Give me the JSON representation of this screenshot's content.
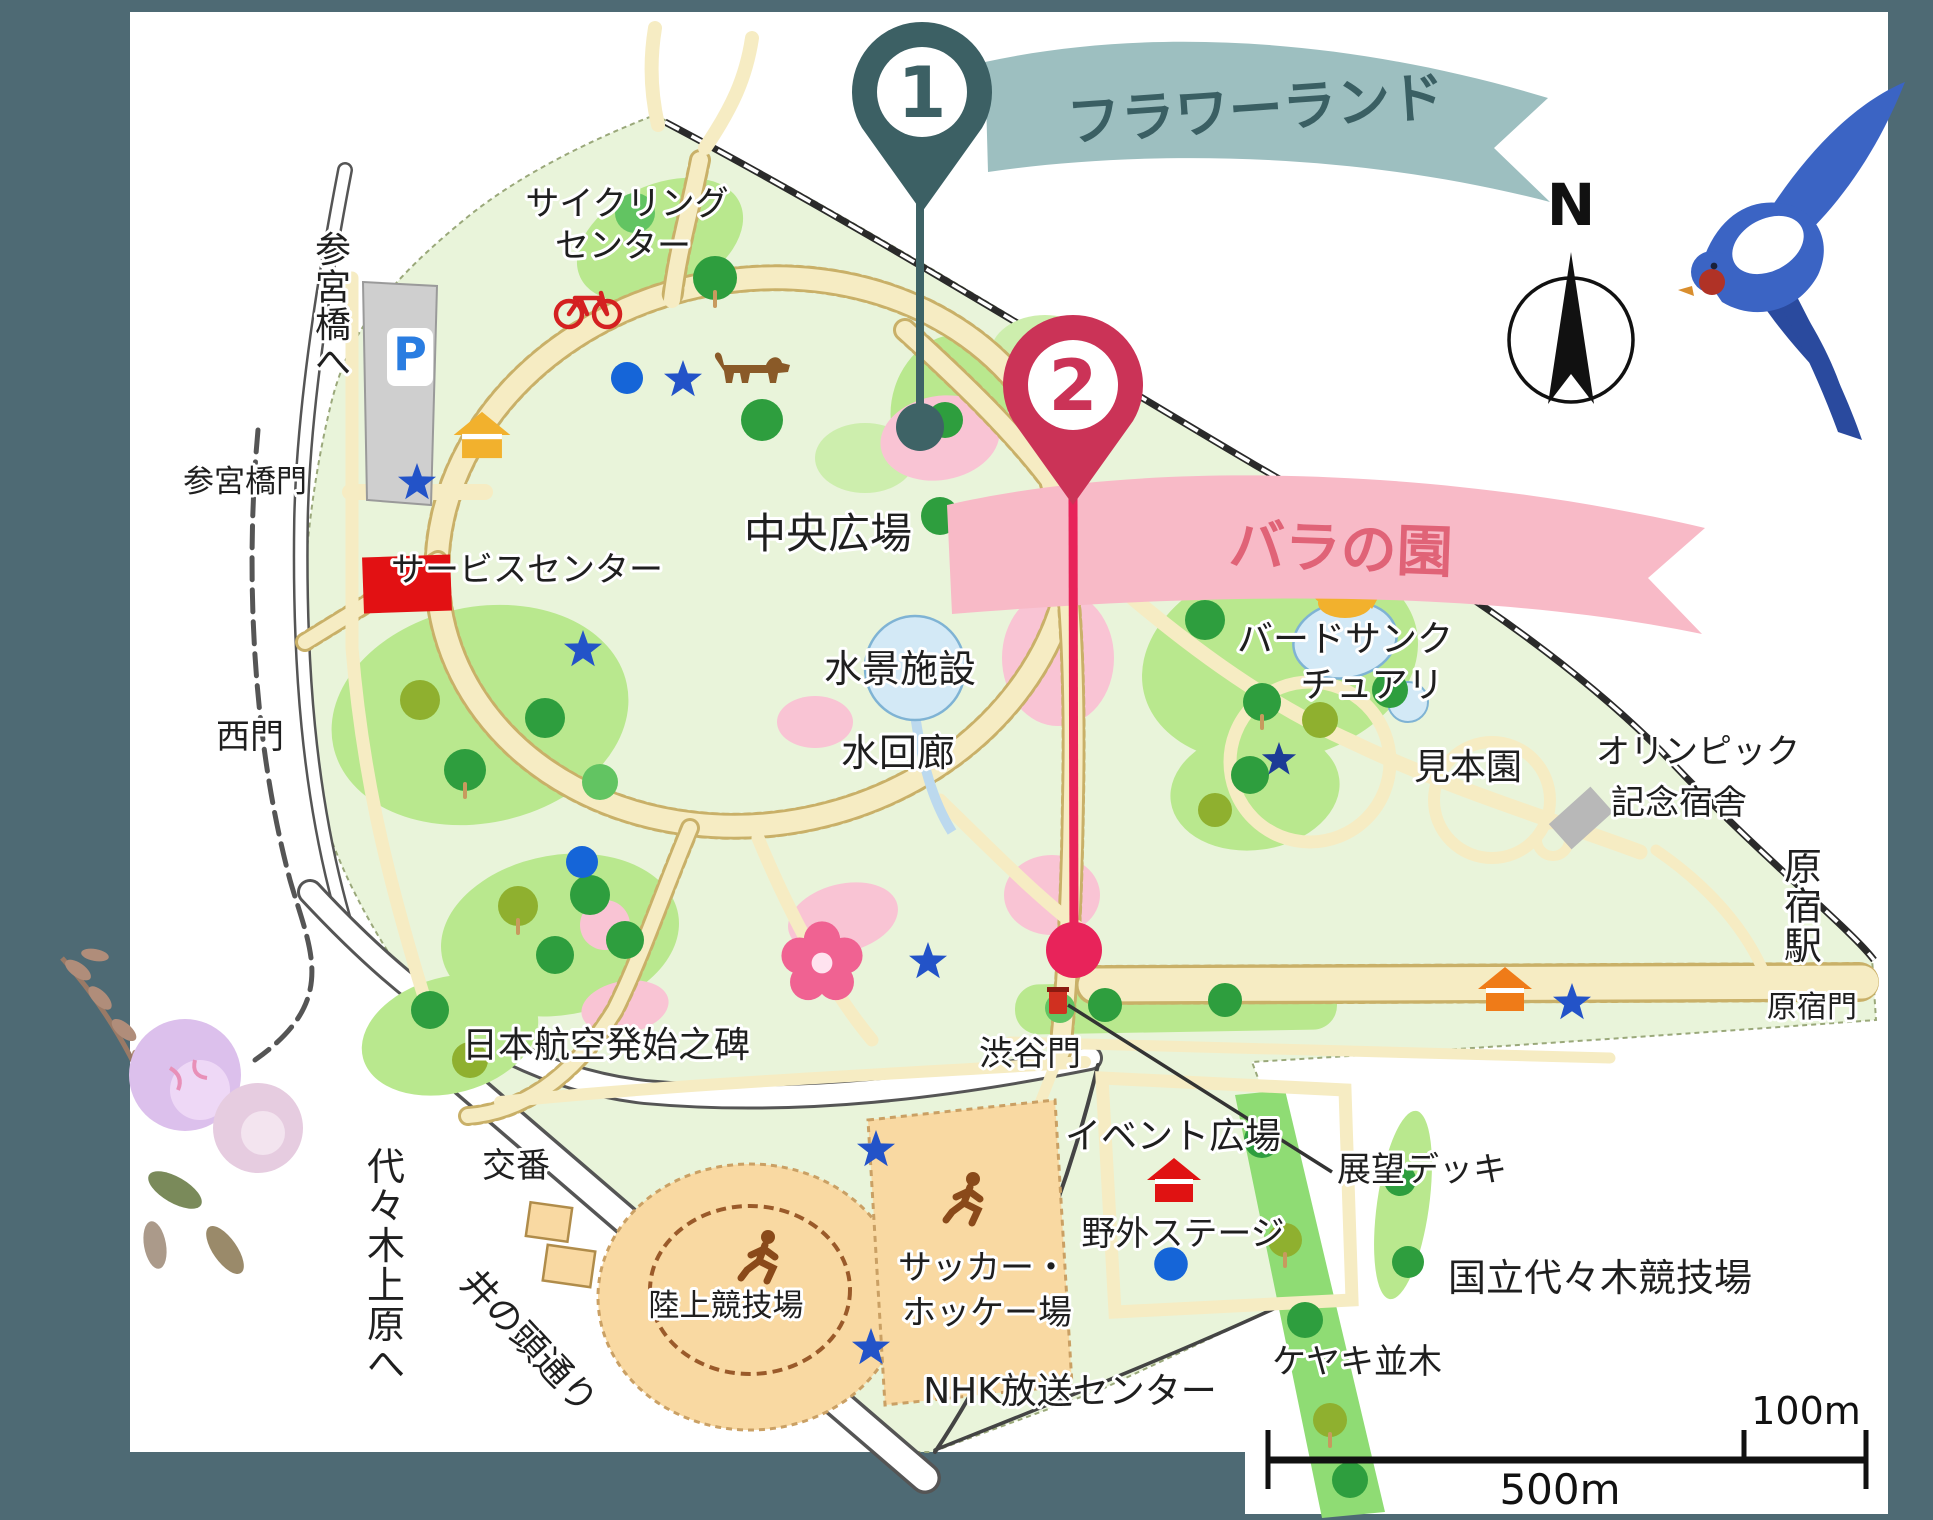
{
  "frame": {
    "background": "#4e6a74",
    "panel": "#ffffff"
  },
  "markers": [
    {
      "number": "1",
      "label": "フラワーランド",
      "pin_color": "#3c6064",
      "stem_color": "#3e6366",
      "banner_bg": "#9dbfc0",
      "banner_text_color": "#3a5f63",
      "pin": {
        "x": 922,
        "y": 92
      },
      "dot": {
        "x": 920,
        "y": 427
      }
    },
    {
      "number": "2",
      "label": "バラの園",
      "pin_color": "#cb3357",
      "stem_color": "#e8235a",
      "banner_bg": "#f8bac7",
      "banner_text_color": "#e06377",
      "pin": {
        "x": 1073,
        "y": 385
      },
      "dot": {
        "x": 1074,
        "y": 950
      }
    }
  ],
  "compass": {
    "label": "N"
  },
  "scale_bar": {
    "long_label": "500m",
    "short_label": "100m"
  },
  "map": {
    "label_color": "#1f1f1f",
    "labels": [
      {
        "id": "cycling-center-1",
        "text": "サイクリング",
        "x": 627,
        "y": 215,
        "size": 34
      },
      {
        "id": "cycling-center-2",
        "text": "センター",
        "x": 623,
        "y": 257,
        "size": 34
      },
      {
        "id": "sangubashi-e",
        "text": "参宮橋へ",
        "x": 333,
        "y": 262,
        "size": 36,
        "vertical": true
      },
      {
        "id": "sangubashi-gate",
        "text": "参宮橋門",
        "x": 245,
        "y": 492,
        "size": 31
      },
      {
        "id": "service-center",
        "text": "サービスセンター",
        "x": 527,
        "y": 581,
        "size": 34
      },
      {
        "id": "west-gate",
        "text": "西門",
        "x": 250,
        "y": 748,
        "size": 34
      },
      {
        "id": "central-square",
        "text": "中央広場",
        "x": 828,
        "y": 548,
        "size": 42
      },
      {
        "id": "water-feature",
        "text": "水景施設",
        "x": 900,
        "y": 682,
        "size": 38
      },
      {
        "id": "water-corridor",
        "text": "水回廊",
        "x": 898,
        "y": 766,
        "size": 38
      },
      {
        "id": "bird-sanctuary-1",
        "text": "バードサンク",
        "x": 1345,
        "y": 651,
        "size": 36
      },
      {
        "id": "bird-sanctuary-2",
        "text": "チュアリ",
        "x": 1372,
        "y": 697,
        "size": 36
      },
      {
        "id": "sample-garden",
        "text": "見本園",
        "x": 1468,
        "y": 779,
        "size": 36
      },
      {
        "id": "olympic-1",
        "text": "オリンピック",
        "x": 1698,
        "y": 763,
        "size": 34
      },
      {
        "id": "olympic-2",
        "text": "記念宿舎",
        "x": 1679,
        "y": 814,
        "size": 34
      },
      {
        "id": "harajuku-sta",
        "text": "原宿駅",
        "x": 1803,
        "y": 880,
        "size": 38,
        "vertical": true
      },
      {
        "id": "harajuku-gate",
        "text": "原宿門",
        "x": 1812,
        "y": 1017,
        "size": 30
      },
      {
        "id": "shibuya-gate",
        "text": "渋谷門",
        "x": 1030,
        "y": 1065,
        "size": 34
      },
      {
        "id": "observation-deck",
        "text": "展望デッキ",
        "x": 1422,
        "y": 1181,
        "size": 34
      },
      {
        "id": "event-plaza",
        "text": "イベント広場",
        "x": 1173,
        "y": 1148,
        "size": 36
      },
      {
        "id": "outdoor-stage",
        "text": "野外ステージ",
        "x": 1183,
        "y": 1245,
        "size": 34
      },
      {
        "id": "jal-monument",
        "text": "日本航空発始之碑",
        "x": 606,
        "y": 1057,
        "size": 36
      },
      {
        "id": "police-box",
        "text": "交番",
        "x": 516,
        "y": 1177,
        "size": 34
      },
      {
        "id": "athletics-field",
        "text": "陸上競技場",
        "x": 726,
        "y": 1316,
        "size": 31
      },
      {
        "id": "soccer-1",
        "text": "サッカー・",
        "x": 983,
        "y": 1279,
        "size": 34
      },
      {
        "id": "soccer-2",
        "text": "ホッケー場",
        "x": 987,
        "y": 1324,
        "size": 34
      },
      {
        "id": "yoyogi-uehara-e",
        "text": "代々木上原へ",
        "x": 386,
        "y": 1180,
        "size": 38,
        "vertical": true
      },
      {
        "id": "inokashira-st",
        "text": "井の頭通り",
        "x": 520,
        "y": 1350,
        "size": 36,
        "rotate": 47
      },
      {
        "id": "nhk-center",
        "text": "NHK放送センター",
        "x": 1070,
        "y": 1403,
        "size": 36
      },
      {
        "id": "zelkova-row",
        "text": "ケヤキ並木",
        "x": 1357,
        "y": 1373,
        "size": 34
      },
      {
        "id": "national-stadium",
        "text": "国立代々木競技場",
        "x": 1600,
        "y": 1291,
        "size": 38
      },
      {
        "id": "parking-p",
        "text": "P",
        "x": 410,
        "y": 370,
        "size": 46,
        "bold": true,
        "color": "#2a7de1"
      }
    ],
    "icons": [
      {
        "type": "star",
        "name": "star-icon-parking",
        "x": 417,
        "y": 483,
        "color": "#2353c8"
      },
      {
        "type": "star",
        "name": "star-icon-dogrun",
        "x": 683,
        "y": 380,
        "color": "#2353c8"
      },
      {
        "type": "star",
        "name": "star-icon-service",
        "x": 583,
        "y": 650,
        "color": "#2353c8"
      },
      {
        "type": "star",
        "name": "star-icon-central",
        "x": 1003,
        "y": 515,
        "color": "#2353c8"
      },
      {
        "type": "star",
        "name": "star-icon-sanctuary",
        "x": 1279,
        "y": 760,
        "color": "#1c3c96",
        "scale": 0.9
      },
      {
        "type": "star",
        "name": "star-icon-shibuya",
        "x": 928,
        "y": 962,
        "color": "#2353c8"
      },
      {
        "type": "star",
        "name": "star-icon-soccer-n",
        "x": 876,
        "y": 1150,
        "color": "#2353c8"
      },
      {
        "type": "star",
        "name": "star-icon-soccer-s",
        "x": 871,
        "y": 1348,
        "color": "#2353c8"
      },
      {
        "type": "star",
        "name": "star-icon-harajuku",
        "x": 1572,
        "y": 1003,
        "color": "#2353c8"
      },
      {
        "type": "dot",
        "name": "dot-icon-cycling",
        "x": 627,
        "y": 378,
        "color": "#1565d8"
      },
      {
        "type": "dot",
        "name": "dot-icon-west",
        "x": 582,
        "y": 862,
        "color": "#1565d8"
      },
      {
        "type": "dot",
        "name": "dot-icon-stage",
        "x": 1171,
        "y": 1264,
        "color": "#1565d8",
        "scale": 1.05
      },
      {
        "type": "house",
        "name": "house-icon-yellow",
        "x": 482,
        "y": 435,
        "color": "#f2b12d",
        "scale": 1.05
      },
      {
        "type": "house",
        "name": "house-icon-stage",
        "x": 1174,
        "y": 1180,
        "color": "#e01212"
      },
      {
        "type": "house",
        "name": "house-icon-harajuku",
        "x": 1505,
        "y": 989,
        "color": "#ef7b18"
      },
      {
        "type": "bike",
        "name": "bicycle-icon",
        "x": 588,
        "y": 307,
        "color": "#d42020"
      },
      {
        "type": "dog",
        "name": "dog-icon",
        "x": 750,
        "y": 375,
        "color": "#8a5a28"
      },
      {
        "type": "bird",
        "name": "bird-icon-sanctuary",
        "x": 1341,
        "y": 601,
        "color": "#f2b12d"
      },
      {
        "type": "runner",
        "name": "runner-icon-track",
        "x": 760,
        "y": 1258,
        "color": "#8a4a1a"
      },
      {
        "type": "runner",
        "name": "runner-icon-soccer",
        "x": 965,
        "y": 1200,
        "color": "#8a4a1a"
      },
      {
        "type": "flower",
        "name": "cherry-blossom-icon",
        "x": 822,
        "y": 963,
        "color": "#f06292",
        "scale": 2.6
      },
      {
        "type": "gate",
        "name": "shibuya-gate-marker",
        "x": 1058,
        "y": 1002,
        "color": "#d03020"
      }
    ]
  }
}
